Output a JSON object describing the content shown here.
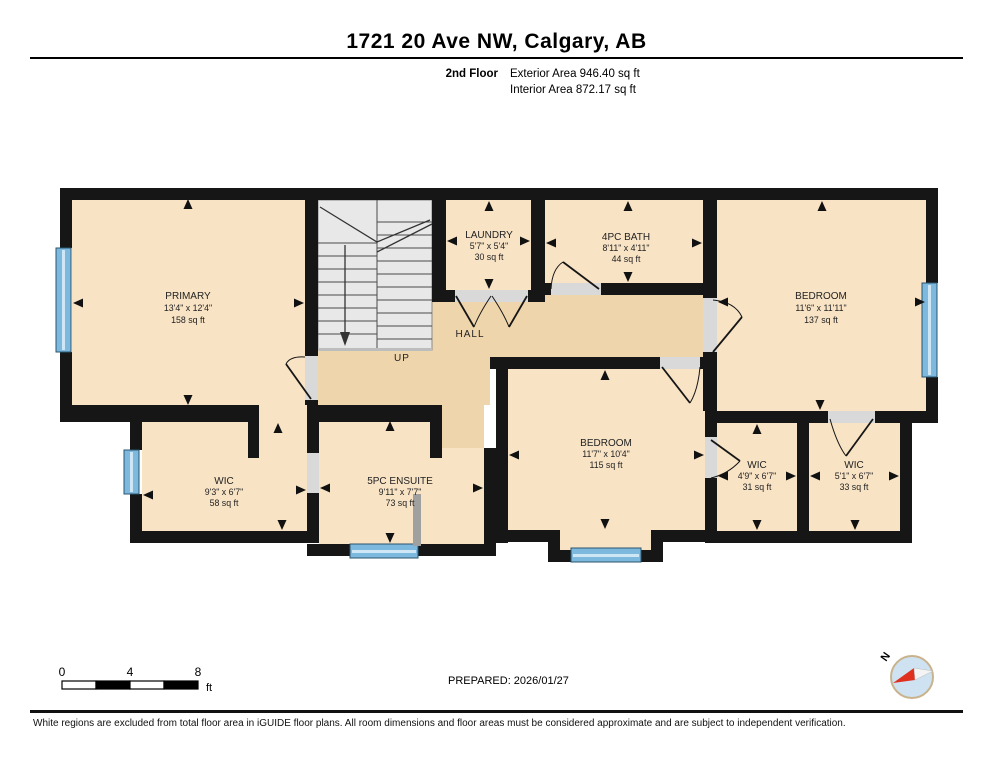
{
  "header": {
    "title": "1721 20 Ave NW, Calgary, AB",
    "floor_label": "2nd Floor",
    "exterior_area": "Exterior Area 946.40 sq ft",
    "interior_area": "Interior Area 872.17 sq ft"
  },
  "plan": {
    "rooms": [
      {
        "name": "PRIMARY",
        "dims": "13'4\" x 12'4\"",
        "area": "158 sq ft"
      },
      {
        "name": "LAUNDRY",
        "dims": "5'7\" x 5'4\"",
        "area": "30 sq ft"
      },
      {
        "name": "4PC BATH",
        "dims": "8'11\" x 4'11\"",
        "area": "44 sq ft"
      },
      {
        "name": "BEDROOM",
        "dims": "11'6\" x 11'11\"",
        "area": "137 sq ft"
      },
      {
        "name": "WIC",
        "dims": "9'3\" x 6'7\"",
        "area": "58 sq ft"
      },
      {
        "name": "5PC ENSUITE",
        "dims": "9'11\" x 7'7\"",
        "area": "73 sq ft"
      },
      {
        "name": "BEDROOM",
        "dims": "11'7\" x 10'4\"",
        "area": "115 sq ft"
      },
      {
        "name": "WIC",
        "dims": "4'9\" x 6'7\"",
        "area": "31 sq ft"
      },
      {
        "name": "WIC",
        "dims": "5'1\" x 6'7\"",
        "area": "33 sq ft"
      }
    ],
    "hall_label": "HALL",
    "up_label": "UP",
    "compass_n": "N",
    "colors": {
      "room_fill": "#f8e3c5",
      "hall_fill": "#efd5ab",
      "wall": "#161616",
      "window": "#7db8de",
      "stairs": "#e8e8e8"
    }
  },
  "scale_bar": {
    "tick_0": "0",
    "tick_4": "4",
    "tick_8": "8",
    "unit": "ft"
  },
  "prepared": "PREPARED: 2026/01/27",
  "footer": "White regions are excluded from total floor area in iGUIDE floor plans. All room dimensions and floor areas must be considered approximate and are subject to independent verification."
}
